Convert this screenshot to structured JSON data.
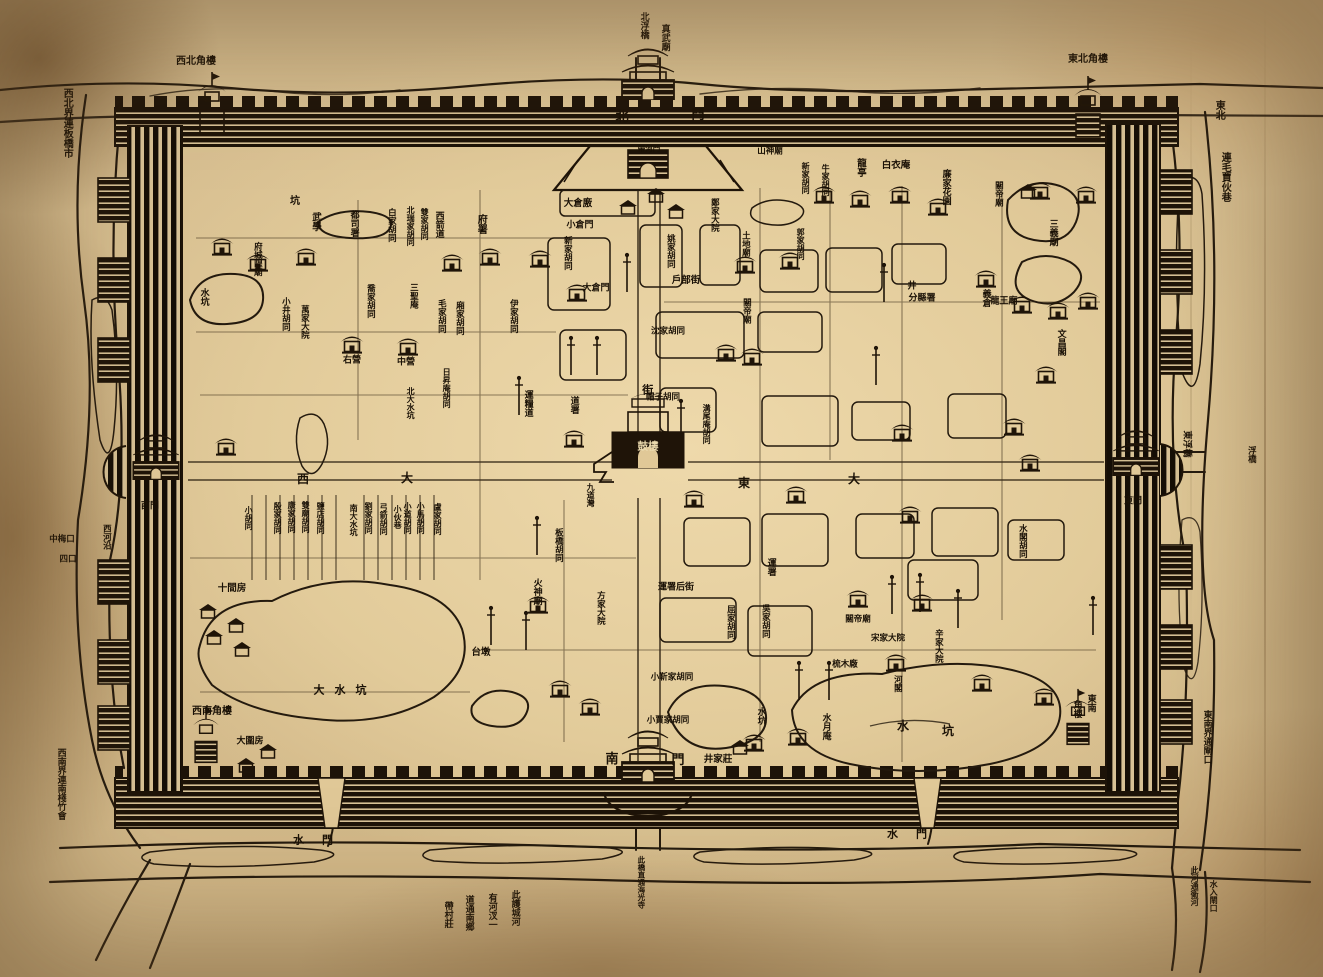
{
  "palette": {
    "paper": "#e0c897",
    "paper_dark": "#b69468",
    "ink": "#1f1408",
    "label_ink": "#1a1106",
    "label_on_dark": "#ead9ad"
  },
  "map": {
    "type": "historical-woodcut-walled-city-map",
    "center_landmark": "鼓樓",
    "gates": {
      "north": "北門",
      "south": "南門",
      "east": "東門",
      "west": "西門",
      "water": "水門"
    },
    "corner_towers": {
      "northwest": "西北角樓",
      "northeast": "東北角樓",
      "southwest": "西南角樓",
      "southeast": "東南角樓"
    },
    "edge_notes": [
      "西北界連板橋市",
      "東北連毛賈伙巷",
      "西南界連南棧竹會",
      "東南界通閘口",
      "此河通衛河 水入閘口",
      "此護城河有河汊一道通南鄉帶村莊"
    ]
  },
  "labels": [
    {
      "t": "真武廟",
      "x": 664,
      "y": 24,
      "o": "v",
      "s": 9
    },
    {
      "t": "北浮橋",
      "x": 643,
      "y": 12,
      "o": "v",
      "s": 9,
      "n": "north-pontoon-bridge-label"
    },
    {
      "t": "西北角樓",
      "x": 196,
      "y": 62,
      "o": "h",
      "s": 10,
      "n": "nw-corner-tower-label"
    },
    {
      "t": "東北角樓",
      "x": 1088,
      "y": 60,
      "o": "h",
      "s": 10,
      "n": "ne-corner-tower-label"
    },
    {
      "t": "西南角樓",
      "x": 212,
      "y": 712,
      "o": "h",
      "s": 10,
      "n": "sw-corner-tower-label"
    },
    {
      "t": "東南",
      "x": 1090,
      "y": 694,
      "o": "v",
      "s": 9,
      "n": "se-corner-tower-label"
    },
    {
      "t": "角樓",
      "x": 1076,
      "y": 700,
      "o": "v",
      "s": 9
    },
    {
      "t": "西北界連板橋市",
      "x": 66,
      "y": 88,
      "o": "v",
      "s": 10
    },
    {
      "t": "東北",
      "x": 1218,
      "y": 100,
      "o": "v",
      "s": 10
    },
    {
      "t": "連毛賈伙巷",
      "x": 1224,
      "y": 152,
      "o": "v",
      "s": 10
    },
    {
      "t": "西南界連南棧竹會",
      "x": 60,
      "y": 748,
      "o": "v",
      "s": 9
    },
    {
      "t": "東南界通閘口",
      "x": 1206,
      "y": 710,
      "o": "v",
      "s": 9
    },
    {
      "t": "此河通衛河",
      "x": 1194,
      "y": 866,
      "o": "v",
      "s": 8
    },
    {
      "t": "水入閘口",
      "x": 1213,
      "y": 880,
      "o": "v",
      "s": 8
    },
    {
      "t": "此護城河",
      "x": 514,
      "y": 890,
      "o": "v",
      "s": 9
    },
    {
      "t": "有河汊一",
      "x": 491,
      "y": 893,
      "o": "v",
      "s": 9
    },
    {
      "t": "道通南鄉",
      "x": 468,
      "y": 895,
      "o": "v",
      "s": 9
    },
    {
      "t": "帶村莊",
      "x": 447,
      "y": 901,
      "o": "v",
      "s": 9
    },
    {
      "t": "水門",
      "x": 322,
      "y": 840,
      "o": "h",
      "s": 11,
      "c": "sp2",
      "n": "west-water-gate-label"
    },
    {
      "t": "水門",
      "x": 916,
      "y": 834,
      "o": "h",
      "s": 11,
      "c": "sp2",
      "n": "east-water-gate-label"
    },
    {
      "t": "此橋直通海光寺",
      "x": 641,
      "y": 856,
      "o": "v",
      "s": 7.5
    },
    {
      "t": "中梅口",
      "x": 62,
      "y": 540,
      "o": "h",
      "s": 8.5
    },
    {
      "t": "四口",
      "x": 68,
      "y": 560,
      "o": "h",
      "s": 8.5
    },
    {
      "t": "西河沿",
      "x": 106,
      "y": 524,
      "o": "v",
      "s": 8.5
    },
    {
      "t": "東浮橋",
      "x": 1186,
      "y": 444,
      "o": "r",
      "s": 9
    },
    {
      "t": "大圍房",
      "x": 250,
      "y": 742,
      "o": "h",
      "s": 9
    },
    {
      "t": "井家莊",
      "x": 718,
      "y": 760,
      "o": "h",
      "s": 9.5
    },
    {
      "t": "浮橋",
      "x": 1251,
      "y": 446,
      "o": "v",
      "s": 8.5
    },
    {
      "t": "北",
      "x": 622,
      "y": 118,
      "o": "h",
      "s": 13,
      "n": "north-gate-label"
    },
    {
      "t": "門",
      "x": 698,
      "y": 116,
      "o": "h",
      "s": 13
    },
    {
      "t": "南",
      "x": 612,
      "y": 760,
      "o": "h",
      "s": 13,
      "n": "south-gate-label"
    },
    {
      "t": "門",
      "x": 678,
      "y": 761,
      "o": "h",
      "s": 13
    },
    {
      "t": "西門",
      "x": 150,
      "y": 507,
      "o": "h",
      "s": 9,
      "n": "west-gate-label"
    },
    {
      "t": "東門",
      "x": 1133,
      "y": 502,
      "o": "h",
      "s": 9,
      "n": "east-gate-label"
    },
    {
      "t": "帶河門",
      "x": 649,
      "y": 149,
      "o": "h",
      "s": 7.5
    },
    {
      "t": "街",
      "x": 647,
      "y": 384,
      "o": "v",
      "s": 11
    },
    {
      "t": "西",
      "x": 303,
      "y": 479,
      "o": "h",
      "s": 12
    },
    {
      "t": "大",
      "x": 407,
      "y": 478,
      "o": "h",
      "s": 12
    },
    {
      "t": "東",
      "x": 744,
      "y": 483,
      "o": "h",
      "s": 12
    },
    {
      "t": "大",
      "x": 854,
      "y": 479,
      "o": "h",
      "s": 12
    },
    {
      "t": "鼓樓",
      "x": 648,
      "y": 447,
      "o": "h",
      "s": 10.5,
      "c": "on-dark",
      "n": "drum-tower-label"
    },
    {
      "t": "道署",
      "x": 573,
      "y": 396,
      "o": "v",
      "s": 9
    },
    {
      "t": "帽子胡同",
      "x": 663,
      "y": 398,
      "o": "h",
      "s": 8.5
    },
    {
      "t": "溝尾庵胡同",
      "x": 706,
      "y": 404,
      "o": "v",
      "s": 8
    },
    {
      "t": "九道灣",
      "x": 590,
      "y": 483,
      "o": "v",
      "s": 8
    },
    {
      "t": "火神廟",
      "x": 536,
      "y": 578,
      "o": "v",
      "s": 9
    },
    {
      "t": "板橋胡同",
      "x": 558,
      "y": 528,
      "o": "v",
      "s": 8.5
    },
    {
      "t": "運糧道",
      "x": 527,
      "y": 390,
      "o": "v",
      "s": 9
    },
    {
      "t": "日昇庵胡同",
      "x": 446,
      "y": 368,
      "o": "v",
      "s": 8
    },
    {
      "t": "北大水坑",
      "x": 410,
      "y": 387,
      "o": "v",
      "s": 8
    },
    {
      "t": "坑",
      "x": 295,
      "y": 202,
      "o": "h",
      "s": 10
    },
    {
      "t": "武學",
      "x": 315,
      "y": 212,
      "o": "v",
      "s": 9.5
    },
    {
      "t": "都司署",
      "x": 353,
      "y": 210,
      "o": "v",
      "s": 9
    },
    {
      "t": "白家胡同",
      "x": 391,
      "y": 208,
      "o": "v",
      "s": 8.5
    },
    {
      "t": "北瑞家胡同",
      "x": 410,
      "y": 206,
      "o": "v",
      "s": 8
    },
    {
      "t": "雙家胡同",
      "x": 424,
      "y": 208,
      "o": "v",
      "s": 8
    },
    {
      "t": "西箭道",
      "x": 438,
      "y": 211,
      "o": "v",
      "s": 9
    },
    {
      "t": "府署",
      "x": 480,
      "y": 214,
      "o": "v",
      "s": 10
    },
    {
      "t": "府城隍廟",
      "x": 257,
      "y": 242,
      "o": "v",
      "s": 8.5
    },
    {
      "t": "小井胡同",
      "x": 285,
      "y": 297,
      "o": "v",
      "s": 8.5
    },
    {
      "t": "萬家大院",
      "x": 304,
      "y": 305,
      "o": "v",
      "s": 8.5
    },
    {
      "t": "喬家胡同",
      "x": 370,
      "y": 284,
      "o": "v",
      "s": 8.5
    },
    {
      "t": "三聖庵",
      "x": 413,
      "y": 283,
      "o": "v",
      "s": 8.5
    },
    {
      "t": "毛家胡同",
      "x": 441,
      "y": 299,
      "o": "v",
      "s": 8.5
    },
    {
      "t": "廂家胡同",
      "x": 459,
      "y": 301,
      "o": "v",
      "s": 8.5
    },
    {
      "t": "伊家胡同",
      "x": 513,
      "y": 299,
      "o": "v",
      "s": 8.5
    },
    {
      "t": "右營",
      "x": 352,
      "y": 361,
      "o": "h",
      "s": 9
    },
    {
      "t": "中營",
      "x": 406,
      "y": 363,
      "o": "h",
      "s": 9
    },
    {
      "t": "大倉廒",
      "x": 578,
      "y": 204,
      "o": "h",
      "s": 9.5
    },
    {
      "t": "小倉門",
      "x": 580,
      "y": 226,
      "o": "h",
      "s": 9
    },
    {
      "t": "新家胡同",
      "x": 567,
      "y": 236,
      "o": "v",
      "s": 8.5
    },
    {
      "t": "大倉門",
      "x": 596,
      "y": 289,
      "o": "h",
      "s": 9
    },
    {
      "t": "姚家胡同",
      "x": 670,
      "y": 234,
      "o": "v",
      "s": 8.5
    },
    {
      "t": "鄭家大院",
      "x": 714,
      "y": 198,
      "o": "v",
      "s": 8.5
    },
    {
      "t": "戶部街",
      "x": 686,
      "y": 281,
      "o": "h",
      "s": 9.5
    },
    {
      "t": "沈家胡同",
      "x": 668,
      "y": 332,
      "o": "h",
      "s": 8.5
    },
    {
      "t": "土地廟",
      "x": 745,
      "y": 231,
      "o": "v",
      "s": 8.5
    },
    {
      "t": "關帝廟",
      "x": 746,
      "y": 298,
      "o": "v",
      "s": 8.5
    },
    {
      "t": "山神廟",
      "x": 770,
      "y": 152,
      "o": "h",
      "s": 8.5
    },
    {
      "t": "新家胡同",
      "x": 805,
      "y": 162,
      "o": "v",
      "s": 8
    },
    {
      "t": "牛家胡同",
      "x": 825,
      "y": 164,
      "o": "v",
      "s": 8
    },
    {
      "t": "龍亭",
      "x": 860,
      "y": 158,
      "o": "v",
      "s": 9.5
    },
    {
      "t": "白衣庵",
      "x": 896,
      "y": 166,
      "o": "h",
      "s": 9.5
    },
    {
      "t": "廉家花園",
      "x": 945,
      "y": 169,
      "o": "v",
      "s": 9
    },
    {
      "t": "關帝廟",
      "x": 998,
      "y": 181,
      "o": "v",
      "s": 8.5
    },
    {
      "t": "郭家胡同",
      "x": 800,
      "y": 228,
      "o": "v",
      "s": 8
    },
    {
      "t": "三義廟",
      "x": 1052,
      "y": 219,
      "o": "v",
      "s": 9
    },
    {
      "t": "井",
      "x": 912,
      "y": 287,
      "o": "h",
      "s": 9
    },
    {
      "t": "分縣署",
      "x": 922,
      "y": 299,
      "o": "h",
      "s": 9
    },
    {
      "t": "義倉",
      "x": 985,
      "y": 289,
      "o": "v",
      "s": 9
    },
    {
      "t": "龍王廟",
      "x": 1004,
      "y": 302,
      "o": "h",
      "s": 9
    },
    {
      "t": "文昌閣",
      "x": 1060,
      "y": 329,
      "o": "v",
      "s": 9
    },
    {
      "t": "水閣胡同",
      "x": 1022,
      "y": 524,
      "o": "v",
      "s": 8.5
    },
    {
      "t": "小胡同",
      "x": 248,
      "y": 506,
      "o": "v",
      "s": 8
    },
    {
      "t": "殷家胡同",
      "x": 277,
      "y": 502,
      "o": "v",
      "s": 8
    },
    {
      "t": "康家胡同",
      "x": 291,
      "y": 501,
      "o": "v",
      "s": 8
    },
    {
      "t": "雙廟胡同",
      "x": 305,
      "y": 501,
      "o": "v",
      "s": 8
    },
    {
      "t": "鹽店胡同",
      "x": 320,
      "y": 502,
      "o": "v",
      "s": 8
    },
    {
      "t": "南大水坑",
      "x": 353,
      "y": 504,
      "o": "v",
      "s": 8
    },
    {
      "t": "劉家胡同",
      "x": 368,
      "y": 502,
      "o": "v",
      "s": 8
    },
    {
      "t": "弓箭胡同",
      "x": 383,
      "y": 503,
      "o": "v",
      "s": 8
    },
    {
      "t": "小伙巷",
      "x": 397,
      "y": 505,
      "o": "v",
      "s": 8
    },
    {
      "t": "小道胡同",
      "x": 407,
      "y": 502,
      "o": "v",
      "s": 8
    },
    {
      "t": "小馬胡同",
      "x": 420,
      "y": 502,
      "o": "v",
      "s": 8
    },
    {
      "t": "盧家胡同",
      "x": 437,
      "y": 503,
      "o": "v",
      "s": 8
    },
    {
      "t": "十間房",
      "x": 232,
      "y": 589,
      "o": "h",
      "s": 9.5
    },
    {
      "t": "大水坑",
      "x": 345,
      "y": 690,
      "o": "h",
      "s": 11,
      "c": "sp"
    },
    {
      "t": "台墩",
      "x": 481,
      "y": 653,
      "o": "h",
      "s": 9.5
    },
    {
      "t": "方家大院",
      "x": 600,
      "y": 591,
      "o": "v",
      "s": 8.5
    },
    {
      "t": "運署后街",
      "x": 676,
      "y": 588,
      "o": "h",
      "s": 9
    },
    {
      "t": "屈家胡同",
      "x": 730,
      "y": 605,
      "o": "v",
      "s": 8.5
    },
    {
      "t": "吳家胡同",
      "x": 765,
      "y": 604,
      "o": "v",
      "s": 8.5
    },
    {
      "t": "小靳家胡同",
      "x": 672,
      "y": 678,
      "o": "h",
      "s": 8.5
    },
    {
      "t": "小賈家胡同",
      "x": 668,
      "y": 721,
      "o": "h",
      "s": 8.5
    },
    {
      "t": "水坑",
      "x": 760,
      "y": 707,
      "o": "v",
      "s": 9
    },
    {
      "t": "水月庵",
      "x": 825,
      "y": 713,
      "o": "v",
      "s": 9
    },
    {
      "t": "水",
      "x": 903,
      "y": 726,
      "o": "h",
      "s": 12
    },
    {
      "t": "坑",
      "x": 948,
      "y": 731,
      "o": "h",
      "s": 12
    },
    {
      "t": "關帝廟",
      "x": 858,
      "y": 620,
      "o": "h",
      "s": 8.5
    },
    {
      "t": "梳木廠",
      "x": 845,
      "y": 665,
      "o": "h",
      "s": 8.5
    },
    {
      "t": "宋家大院",
      "x": 888,
      "y": 639,
      "o": "h",
      "s": 8.5
    },
    {
      "t": "辛家大院",
      "x": 938,
      "y": 629,
      "o": "v",
      "s": 8.5
    },
    {
      "t": "河閣",
      "x": 897,
      "y": 675,
      "o": "v",
      "s": 8.5
    },
    {
      "t": "運署",
      "x": 770,
      "y": 558,
      "o": "v",
      "s": 9
    },
    {
      "t": "水坑",
      "x": 203,
      "y": 288,
      "o": "v",
      "s": 9
    }
  ],
  "features": [
    {
      "k": "temple",
      "x": 222,
      "y": 246
    },
    {
      "k": "temple",
      "x": 258,
      "y": 262
    },
    {
      "k": "temple",
      "x": 306,
      "y": 256
    },
    {
      "k": "temple",
      "x": 352,
      "y": 344
    },
    {
      "k": "temple",
      "x": 408,
      "y": 346
    },
    {
      "k": "temple",
      "x": 452,
      "y": 262
    },
    {
      "k": "temple",
      "x": 490,
      "y": 256
    },
    {
      "k": "temple",
      "x": 540,
      "y": 258
    },
    {
      "k": "temple",
      "x": 577,
      "y": 292
    },
    {
      "k": "temple",
      "x": 745,
      "y": 264
    },
    {
      "k": "temple",
      "x": 790,
      "y": 260
    },
    {
      "k": "temple",
      "x": 824,
      "y": 194
    },
    {
      "k": "temple",
      "x": 860,
      "y": 198
    },
    {
      "k": "temple",
      "x": 900,
      "y": 194
    },
    {
      "k": "temple",
      "x": 938,
      "y": 206
    },
    {
      "k": "temple",
      "x": 986,
      "y": 278
    },
    {
      "k": "temple",
      "x": 1022,
      "y": 304
    },
    {
      "k": "temple",
      "x": 1058,
      "y": 310
    },
    {
      "k": "temple",
      "x": 1088,
      "y": 300
    },
    {
      "k": "temple",
      "x": 1046,
      "y": 374
    },
    {
      "k": "temple",
      "x": 1014,
      "y": 426
    },
    {
      "k": "temple",
      "x": 902,
      "y": 432
    },
    {
      "k": "temple",
      "x": 752,
      "y": 356
    },
    {
      "k": "temple",
      "x": 726,
      "y": 352
    },
    {
      "k": "temple",
      "x": 574,
      "y": 438
    },
    {
      "k": "temple",
      "x": 694,
      "y": 498
    },
    {
      "k": "temple",
      "x": 796,
      "y": 494
    },
    {
      "k": "temple",
      "x": 910,
      "y": 514
    },
    {
      "k": "temple",
      "x": 1030,
      "y": 462
    },
    {
      "k": "temple",
      "x": 922,
      "y": 602
    },
    {
      "k": "temple",
      "x": 858,
      "y": 598
    },
    {
      "k": "temple",
      "x": 896,
      "y": 662
    },
    {
      "k": "temple",
      "x": 982,
      "y": 682
    },
    {
      "k": "temple",
      "x": 1044,
      "y": 696
    },
    {
      "k": "temple",
      "x": 538,
      "y": 604
    },
    {
      "k": "temple",
      "x": 560,
      "y": 688
    },
    {
      "k": "temple",
      "x": 590,
      "y": 706
    },
    {
      "k": "temple",
      "x": 754,
      "y": 742
    },
    {
      "k": "temple",
      "x": 798,
      "y": 736
    },
    {
      "k": "temple",
      "x": 226,
      "y": 446
    },
    {
      "k": "temple",
      "x": 1086,
      "y": 194
    },
    {
      "k": "temple",
      "x": 1040,
      "y": 190
    },
    {
      "k": "house",
      "x": 628,
      "y": 208
    },
    {
      "k": "house",
      "x": 656,
      "y": 196
    },
    {
      "k": "house",
      "x": 676,
      "y": 212
    },
    {
      "k": "house",
      "x": 246,
      "y": 766
    },
    {
      "k": "house",
      "x": 268,
      "y": 752
    },
    {
      "k": "house",
      "x": 1028,
      "y": 192
    },
    {
      "k": "house",
      "x": 740,
      "y": 748
    },
    {
      "k": "house",
      "x": 208,
      "y": 612
    },
    {
      "k": "house",
      "x": 236,
      "y": 626
    },
    {
      "k": "house",
      "x": 214,
      "y": 638
    },
    {
      "k": "house",
      "x": 242,
      "y": 650
    },
    {
      "k": "pole",
      "x": 571,
      "y": 371
    },
    {
      "k": "pole",
      "x": 597,
      "y": 371
    },
    {
      "k": "pole",
      "x": 627,
      "y": 288
    },
    {
      "k": "pole",
      "x": 681,
      "y": 434
    },
    {
      "k": "pole",
      "x": 876,
      "y": 381
    },
    {
      "k": "pole",
      "x": 892,
      "y": 610
    },
    {
      "k": "pole",
      "x": 920,
      "y": 608
    },
    {
      "k": "pole",
      "x": 491,
      "y": 641
    },
    {
      "k": "pole",
      "x": 526,
      "y": 646
    },
    {
      "k": "pole",
      "x": 799,
      "y": 696
    },
    {
      "k": "pole",
      "x": 829,
      "y": 696
    },
    {
      "k": "pole",
      "x": 958,
      "y": 624
    },
    {
      "k": "pole",
      "x": 1093,
      "y": 631
    },
    {
      "k": "pole",
      "x": 537,
      "y": 551
    },
    {
      "k": "pole",
      "x": 519,
      "y": 411
    },
    {
      "k": "pole",
      "x": 884,
      "y": 298
    }
  ]
}
